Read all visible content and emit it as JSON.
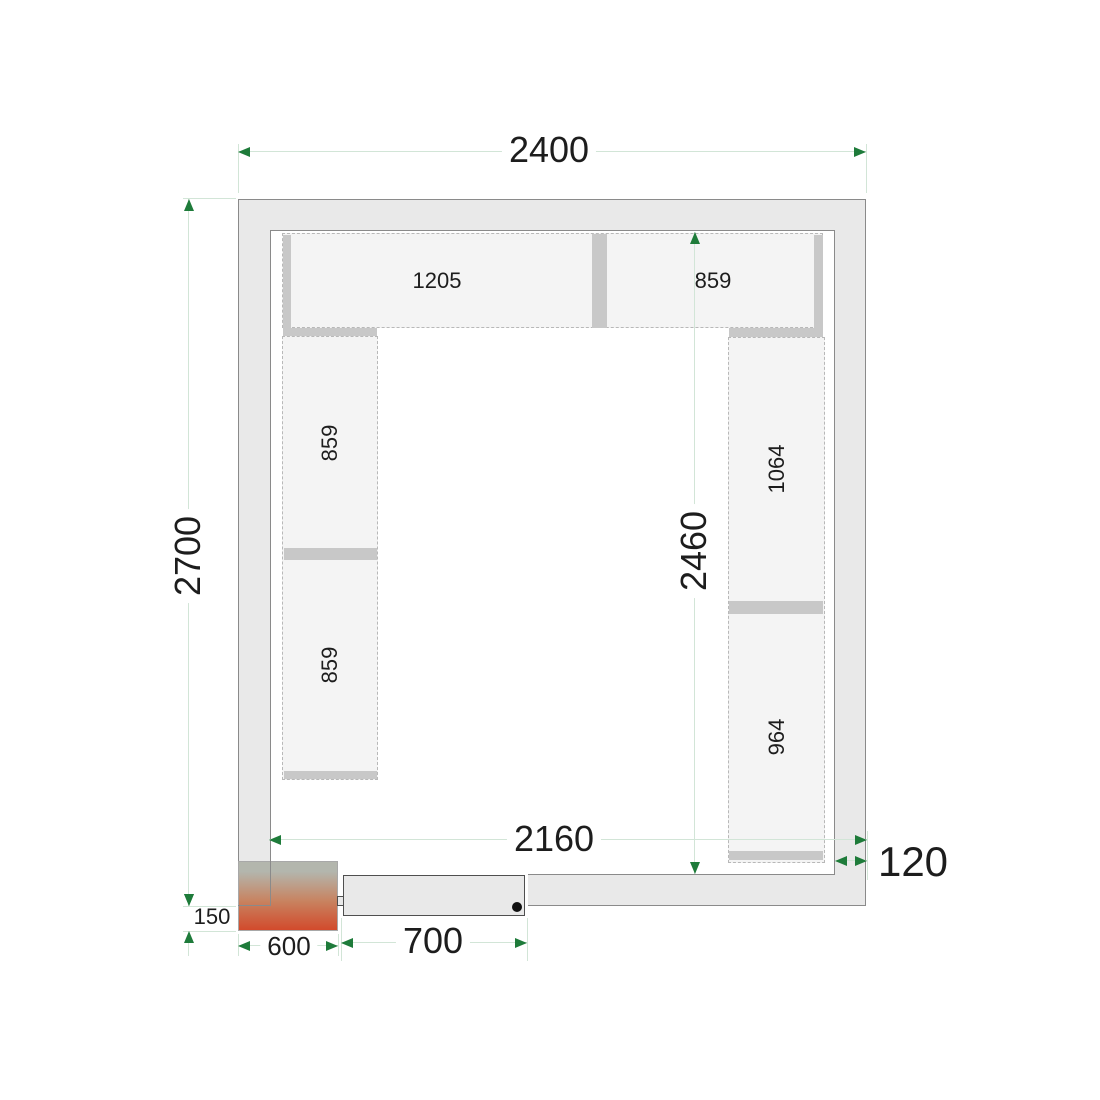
{
  "diagram": {
    "type": "cold-room-floor-plan",
    "colors": {
      "background": "#ffffff",
      "wall_fill": "#e9e9e9",
      "wall_line": "#8a8a8a",
      "shelf_fill": "#f4f4f4",
      "shelf_dash": "#b8b8b8",
      "shelf_bar": "#c8c8c8",
      "dim_line": "#d2e5d7",
      "dim_arrow": "#1e7b3a",
      "text": "#1d1d1d",
      "door_fill": "#e9e9e9",
      "door_line": "#4f4f4f",
      "hinge_dot": "#111111",
      "unit_gradient_top": "#b3b6ad",
      "unit_gradient_mid": "#c8825f",
      "unit_gradient_bottom": "#d24a2c",
      "unit_line": "#a8a8a8"
    },
    "walls": {
      "outer": {
        "x": 238,
        "y": 199,
        "w": 628,
        "h": 707
      },
      "inner": {
        "x": 270,
        "y": 230,
        "w": 565,
        "h": 645
      },
      "door_opening": {
        "x": 338,
        "y": 874,
        "w": 190,
        "h": 38
      }
    },
    "door": {
      "notch": {
        "x": 337,
        "y": 896,
        "w": 10,
        "h": 10
      },
      "leaf": {
        "x": 343,
        "y": 875,
        "w": 182,
        "h": 41
      },
      "hinge_dot": {
        "x": 512,
        "y": 902,
        "w": 10,
        "h": 10
      }
    },
    "condensing_unit": {
      "rect": {
        "x": 238,
        "y": 861,
        "w": 100,
        "h": 70
      },
      "overlay_lines": [
        {
          "x": 270,
          "y": 861,
          "w": 1,
          "h": 45
        },
        {
          "x": 238,
          "y": 905,
          "w": 33,
          "h": 1
        }
      ]
    },
    "shelves": {
      "rects": [
        {
          "id": "shelf-top",
          "x": 282,
          "y": 233,
          "w": 541,
          "h": 95
        },
        {
          "id": "shelf-left",
          "x": 282,
          "y": 336,
          "w": 96,
          "h": 444
        },
        {
          "id": "shelf-right",
          "x": 728,
          "y": 337,
          "w": 97,
          "h": 526
        }
      ],
      "bars": [
        {
          "id": "top-left-cap",
          "x": 283,
          "y": 235,
          "w": 8,
          "h": 93
        },
        {
          "id": "top-divider",
          "x": 592,
          "y": 234,
          "w": 15,
          "h": 94
        },
        {
          "id": "top-right-cap",
          "x": 814,
          "y": 235,
          "w": 9,
          "h": 96
        },
        {
          "id": "left-top-cap",
          "x": 283,
          "y": 328,
          "w": 94,
          "h": 8
        },
        {
          "id": "left-divider",
          "x": 284,
          "y": 548,
          "w": 93,
          "h": 12
        },
        {
          "id": "left-bottom-cap",
          "x": 284,
          "y": 771,
          "w": 93,
          "h": 8
        },
        {
          "id": "right-top-cap",
          "x": 729,
          "y": 328,
          "w": 94,
          "h": 9
        },
        {
          "id": "right-divider",
          "x": 729,
          "y": 601,
          "w": 94,
          "h": 13
        },
        {
          "id": "right-bottom-cap",
          "x": 729,
          "y": 851,
          "w": 94,
          "h": 9
        }
      ],
      "labels": [
        {
          "text": "1205",
          "x": 437,
          "y": 281,
          "rot": false,
          "size": 22
        },
        {
          "text": "859",
          "x": 713,
          "y": 281,
          "rot": false,
          "size": 22
        },
        {
          "text": "859",
          "x": 330,
          "y": 443,
          "rot": true,
          "size": 22
        },
        {
          "text": "859",
          "x": 330,
          "y": 665,
          "rot": true,
          "size": 22
        },
        {
          "text": "1064",
          "x": 777,
          "y": 469,
          "rot": true,
          "size": 22
        },
        {
          "text": "964",
          "x": 777,
          "y": 737,
          "rot": true,
          "size": 22
        }
      ]
    },
    "dimensions": [
      {
        "name": "outer-width",
        "value": "2400",
        "lines": [
          {
            "x1": 238,
            "y1": 151,
            "x2": 866,
            "y2": 151
          }
        ],
        "arrows": [
          {
            "x": 238,
            "y": 151,
            "dir": "left"
          },
          {
            "x": 866,
            "y": 151,
            "dir": "right"
          }
        ],
        "exts": [
          {
            "x1": 238,
            "y1": 144,
            "x2": 238,
            "y2": 193
          },
          {
            "x1": 866,
            "y1": 144,
            "x2": 866,
            "y2": 193
          }
        ],
        "label": {
          "x": 549,
          "y": 150,
          "rot": false,
          "size": 36,
          "bg": true
        }
      },
      {
        "name": "outer-depth",
        "value": "2700",
        "lines": [
          {
            "x1": 188,
            "y1": 199,
            "x2": 188,
            "y2": 906
          }
        ],
        "arrows": [
          {
            "x": 188,
            "y": 199,
            "dir": "up"
          },
          {
            "x": 188,
            "y": 906,
            "dir": "down"
          }
        ],
        "exts": [
          {
            "x1": 183,
            "y1": 198,
            "x2": 236,
            "y2": 198
          },
          {
            "x1": 183,
            "y1": 906,
            "x2": 236,
            "y2": 906
          }
        ],
        "label": {
          "x": 188,
          "y": 556,
          "rot": true,
          "size": 36,
          "bg": true
        }
      },
      {
        "name": "inner-depth",
        "value": "2460",
        "lines": [
          {
            "x1": 694,
            "y1": 232,
            "x2": 694,
            "y2": 874
          }
        ],
        "arrows": [
          {
            "x": 694,
            "y": 232,
            "dir": "up"
          },
          {
            "x": 694,
            "y": 874,
            "dir": "down"
          }
        ],
        "exts": [],
        "label": {
          "x": 694,
          "y": 551,
          "rot": true,
          "size": 36,
          "bg": true
        }
      },
      {
        "name": "inner-width",
        "value": "2160",
        "lines": [
          {
            "x1": 269,
            "y1": 839,
            "x2": 867,
            "y2": 839
          }
        ],
        "arrows": [
          {
            "x": 269,
            "y": 839,
            "dir": "left"
          },
          {
            "x": 867,
            "y": 839,
            "dir": "right"
          }
        ],
        "exts": [
          {
            "x1": 867,
            "y1": 831,
            "x2": 867,
            "y2": 880
          }
        ],
        "label": {
          "x": 554,
          "y": 839,
          "rot": false,
          "size": 36,
          "bg": true
        }
      },
      {
        "name": "wall-thickness",
        "value": "120",
        "lines": [
          {
            "x1": 835,
            "y1": 860,
            "x2": 867,
            "y2": 860
          }
        ],
        "arrows": [
          {
            "x": 835,
            "y": 860,
            "dir": "left"
          },
          {
            "x": 867,
            "y": 860,
            "dir": "right"
          }
        ],
        "exts": [],
        "label": {
          "x": 913,
          "y": 862,
          "rot": false,
          "size": 42,
          "bg": false
        }
      },
      {
        "name": "unit-protrusion",
        "value": "150",
        "lines": [
          {
            "x1": 188,
            "y1": 882,
            "x2": 188,
            "y2": 894
          },
          {
            "x1": 188,
            "y1": 943,
            "x2": 188,
            "y2": 956
          }
        ],
        "arrows": [
          {
            "x": 188,
            "y": 906,
            "dir": "down"
          },
          {
            "x": 188,
            "y": 931,
            "dir": "up"
          }
        ],
        "exts": [
          {
            "x1": 183,
            "y1": 931,
            "x2": 236,
            "y2": 931
          }
        ],
        "label": {
          "x": 212,
          "y": 917,
          "rot": false,
          "size": 22,
          "bg": false
        }
      },
      {
        "name": "unit-width",
        "value": "600",
        "lines": [
          {
            "x1": 238,
            "y1": 945,
            "x2": 338,
            "y2": 945
          }
        ],
        "arrows": [
          {
            "x": 238,
            "y": 945,
            "dir": "left"
          },
          {
            "x": 338,
            "y": 945,
            "dir": "right"
          }
        ],
        "exts": [
          {
            "x1": 238,
            "y1": 934,
            "x2": 238,
            "y2": 956
          },
          {
            "x1": 338,
            "y1": 934,
            "x2": 338,
            "y2": 956
          }
        ],
        "label": {
          "x": 289,
          "y": 946,
          "rot": false,
          "size": 26,
          "bg": true
        }
      },
      {
        "name": "door-width",
        "value": "700",
        "lines": [
          {
            "x1": 341,
            "y1": 942,
            "x2": 527,
            "y2": 942
          }
        ],
        "arrows": [
          {
            "x": 341,
            "y": 942,
            "dir": "left"
          },
          {
            "x": 527,
            "y": 942,
            "dir": "right"
          }
        ],
        "exts": [
          {
            "x1": 341,
            "y1": 918,
            "x2": 341,
            "y2": 961
          },
          {
            "x1": 527,
            "y1": 918,
            "x2": 527,
            "y2": 961
          }
        ],
        "label": {
          "x": 433,
          "y": 941,
          "rot": false,
          "size": 36,
          "bg": true
        }
      }
    ]
  }
}
